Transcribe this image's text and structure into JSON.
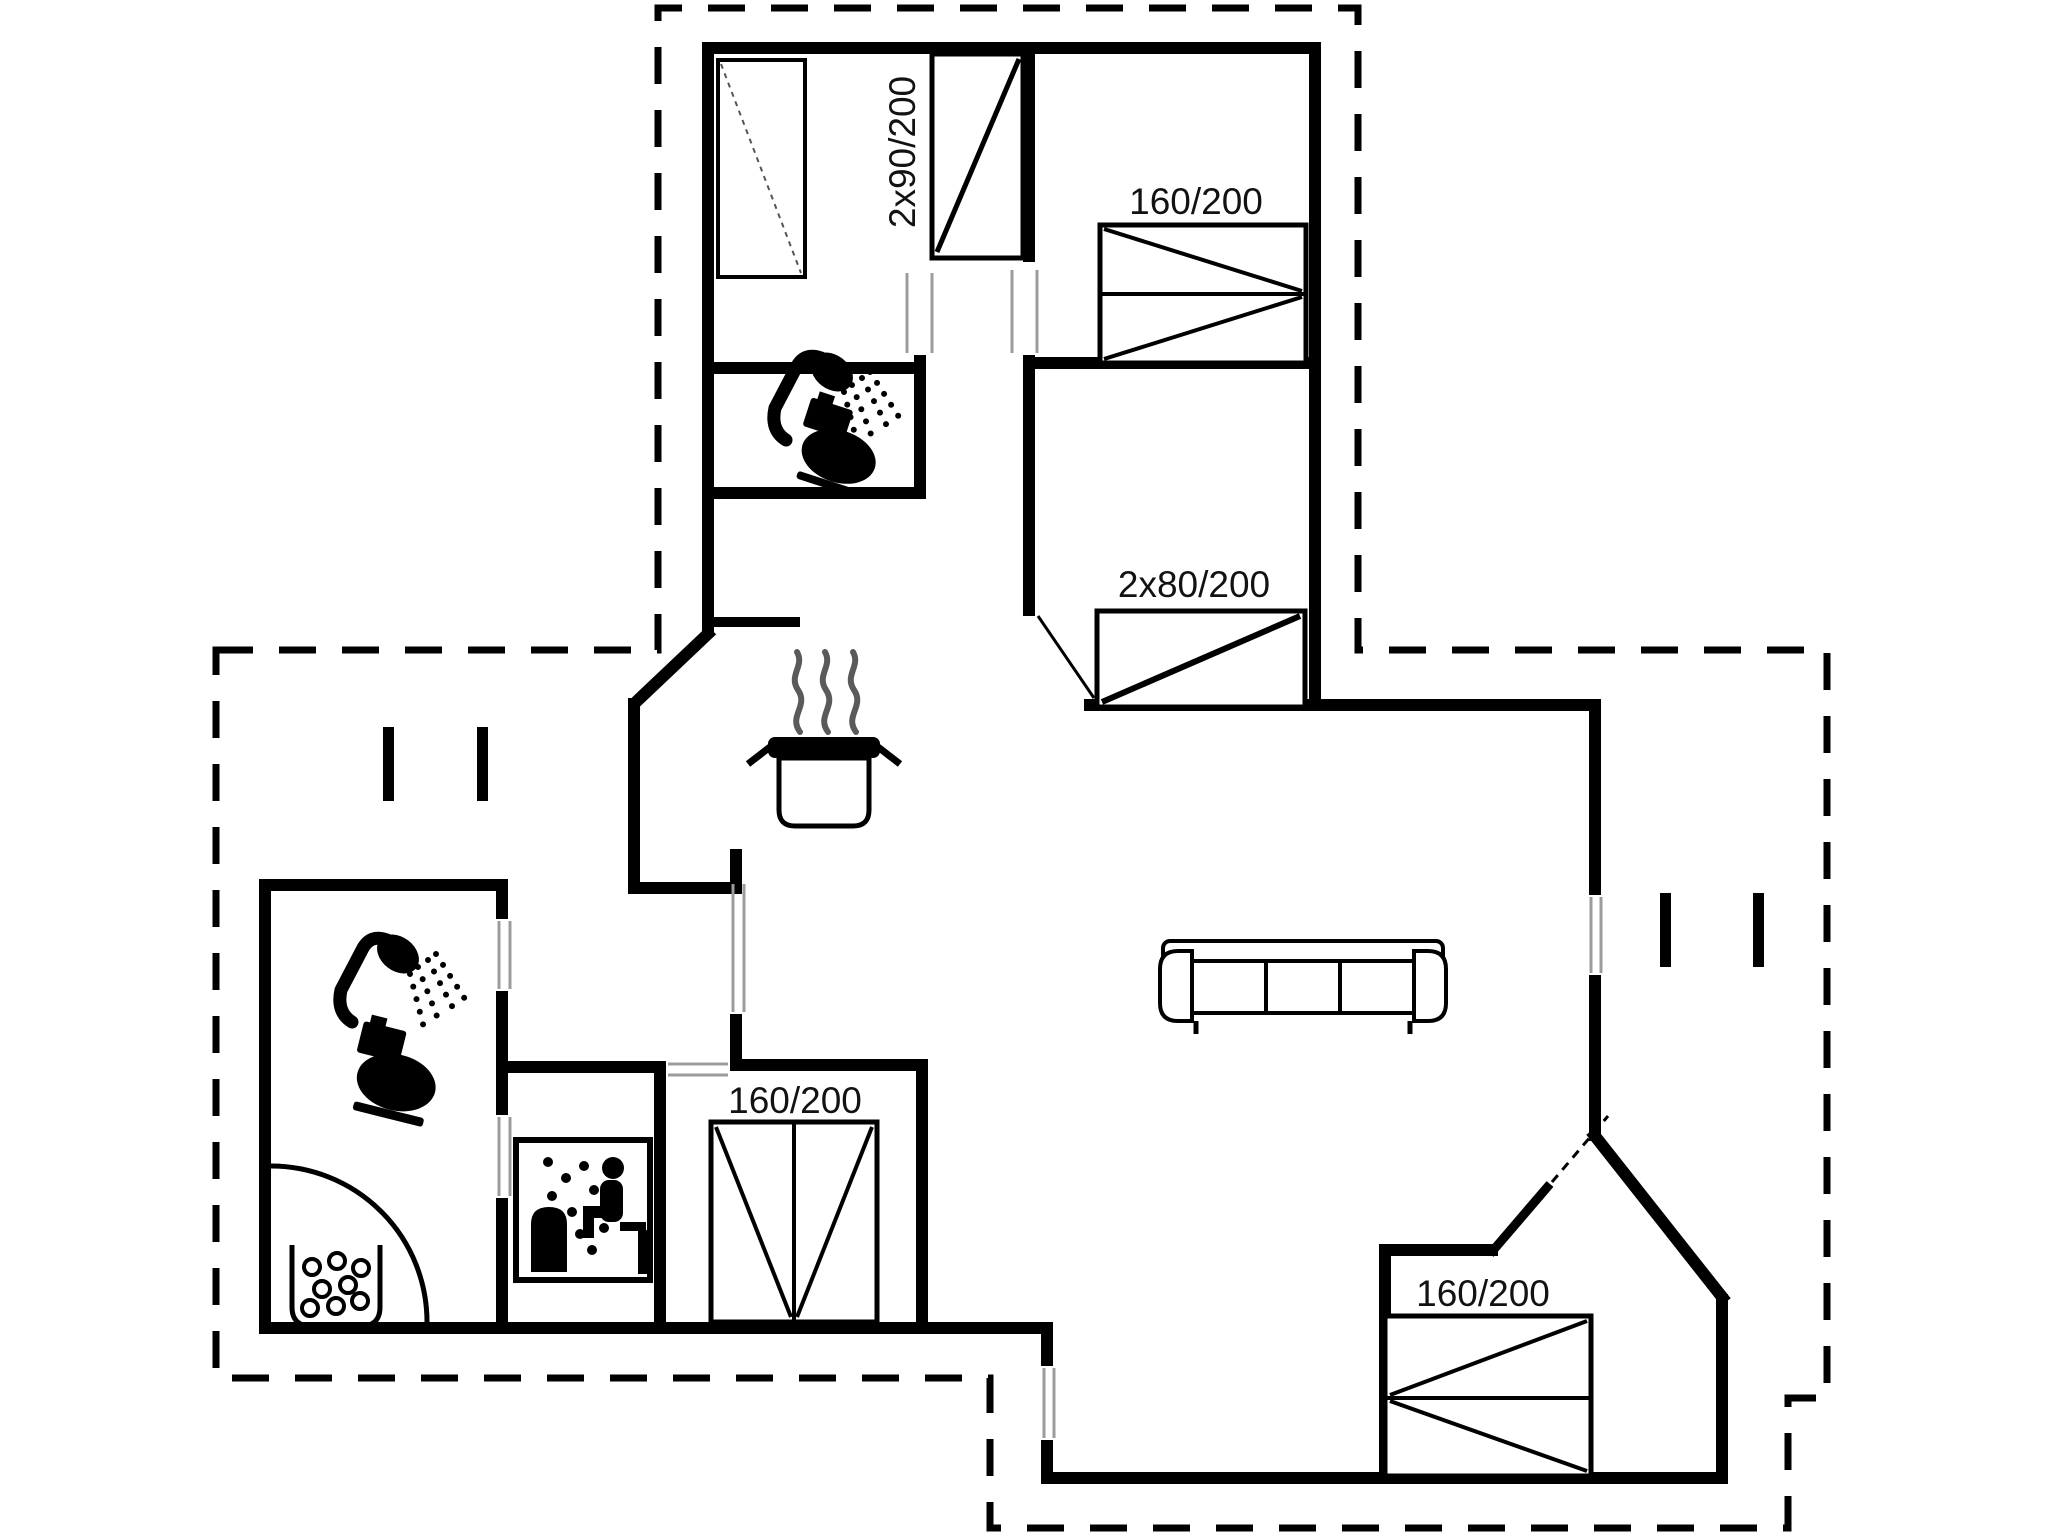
{
  "document": {
    "type": "floor-plan",
    "background_color": "#ffffff",
    "wall_color": "#000000",
    "jamb_color": "#9c9c9c",
    "steam_color": "#5a5a5a",
    "text_color": "#121212"
  },
  "rooms": {
    "bedroom_top_left": {
      "furniture": [
        "wardrobe",
        "bunk-bed"
      ]
    },
    "bathroom_top": {
      "furniture": [
        "shower",
        "toilet"
      ]
    },
    "bedroom_top_right": {
      "furniture": [
        "double-bed"
      ]
    },
    "bedroom_right": {
      "furniture": [
        "double-bed"
      ]
    },
    "bathroom_left": {
      "furniture": [
        "shower",
        "toilet",
        "whirlpool"
      ]
    },
    "sauna": {
      "furniture": [
        "sauna-bench"
      ]
    },
    "bedroom_middle": {
      "furniture": [
        "double-bed"
      ]
    },
    "bedroom_bottom_right": {
      "furniture": [
        "double-bed"
      ]
    },
    "living_room": {
      "furniture": [
        "sofa"
      ]
    },
    "kitchen": {
      "furniture": [
        "stove-pot"
      ]
    }
  },
  "bed_labels": {
    "bunk_bed": "2x90/200",
    "bed_top_right": "160/200",
    "bed_right": "2x80/200",
    "bed_middle": "160/200",
    "bed_bottom_right": "160/200"
  },
  "icons": [
    "wardrobe-icon",
    "bunk-bed-icon",
    "double-bed-icon",
    "shower-icon",
    "toilet-icon",
    "whirlpool-icon",
    "sauna-icon",
    "stove-pot-icon",
    "sofa-icon"
  ]
}
